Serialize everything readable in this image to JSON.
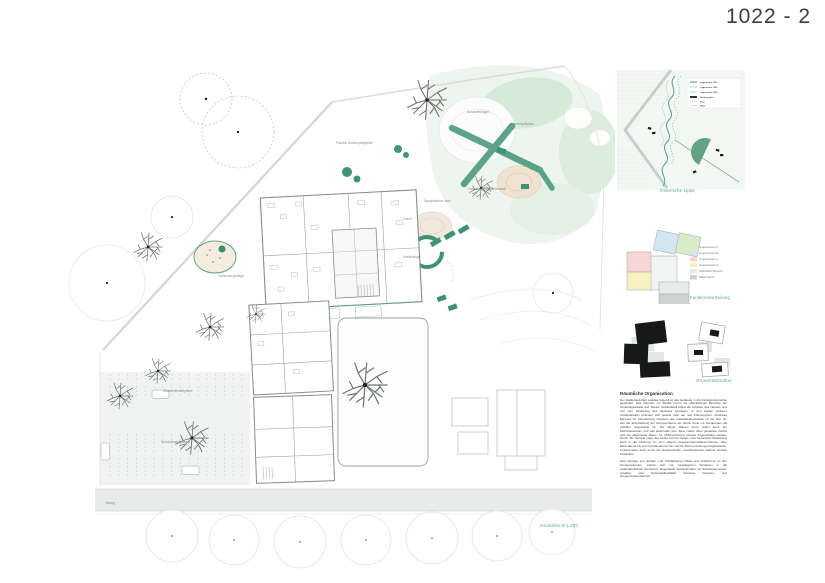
{
  "board": {
    "title": "1022 - 2"
  },
  "plan": {
    "caption": "Grundriss M 1:200",
    "labels": {
      "pavilion": "Pavillon Außenspielgeräte",
      "lookout_hill": "Aussichtshügel",
      "water_playground": "Wasserspielplatz",
      "movement_landscape": "Holzbewegungslandschaft",
      "topographic_island": "Topografische Insel",
      "tunnel": "Tunnel",
      "climbing_hill": "Kletterhügel",
      "animal_enclosure": "Kaninchengehege",
      "staff_parking": "Mitarbeiterstellplätze",
      "visitor_parking": "Besucherstellplätze",
      "street": "Talweg"
    }
  },
  "sidebar": {
    "site_map": {
      "caption": "historische Lippe",
      "legend": [
        "Lippeverlauf 1815",
        "Lippeverlauf 1900",
        "Lippeverlauf 1938",
        "Neubaugebiet",
        "Weg",
        "Wald"
      ]
    },
    "function_diagram": {
      "caption": "Funktionsverteilung",
      "legend": [
        {
          "label": "Gruppenraum A",
          "color": "#d9ecc9"
        },
        {
          "label": "Gruppenraum B",
          "color": "#d2e7f2"
        },
        {
          "label": "Gruppenraum C",
          "color": "#f7d6d5"
        },
        {
          "label": "Gruppenraum D",
          "color": "#f9f0c0"
        },
        {
          "label": "Öffentlicher Bereich",
          "color": "#e8ebe9"
        },
        {
          "label": "Nebenräume",
          "color": "#ccd3d1"
        }
      ]
    },
    "structure_diagram": {
      "caption": "Grundrissstruktur"
    },
    "text_block": {
      "heading": "Räumliche Organisation",
      "paragraphs": [
        "Der städtebaulichen Leitidee folgend ist das Gebäude in drei Funktionsbereiche gegliedert. Das Volumen zur Straße nimmt die öffentlicheren Bereiche der Kindertagesstätte auf. Dieser Gebäudeteil bildet die Adresse des Hauses und soll zum Ortsbezug des Neubaus beitragen. In den beiden anderen Gebäudeteilen befinden sich jeweils zwei der vier Kita-Gruppen. Zentrales Element zur Orientierung zwischen den Gebäudeabschnitten ist der Hof, um den die Erschließung der Gruppenräume als offene Zone mit Garderoben als Spielflur angeordnet ist. Teil dieser offenen Zone sollen auch der Mehrzweckraum und das Elterncafé sein. Eine relativ offen gestaltete Küche und der allgemeine Raum zur Differenzierung können zugeschaltet werden. Durch die zentrale Lage des Hofes kommt diesem eine besondere Bedeutung auch in der Nutzung zu: Vom offenen Gruppenraum/Klassenzimmer, über Elternabend bis zum Familienfest ist der Hof für diverse Nutzungsmöglichkeiten, insbesondere auch durch die angrenzenden, kombinierbaren Räume, flexibel bespielbar.",
        "Eine Spange aus Sanitär- und Schlafräumen bildet eine Pufferzone zu den Gruppenräumen, welche sich mit vorgelagerten Terrassen in die Außenlandschaft orientieren. Eingebaute Schrankmöbel mit Schiebeelementen schaffen eine Nutzungsflexibilität zwischen Gruppen- und Gruppennebenräumen."
      ]
    }
  },
  "colors": {
    "accent_teal": "#4fa08b",
    "plan_green": "#4c9a7f",
    "diagram_black": "#171918"
  }
}
